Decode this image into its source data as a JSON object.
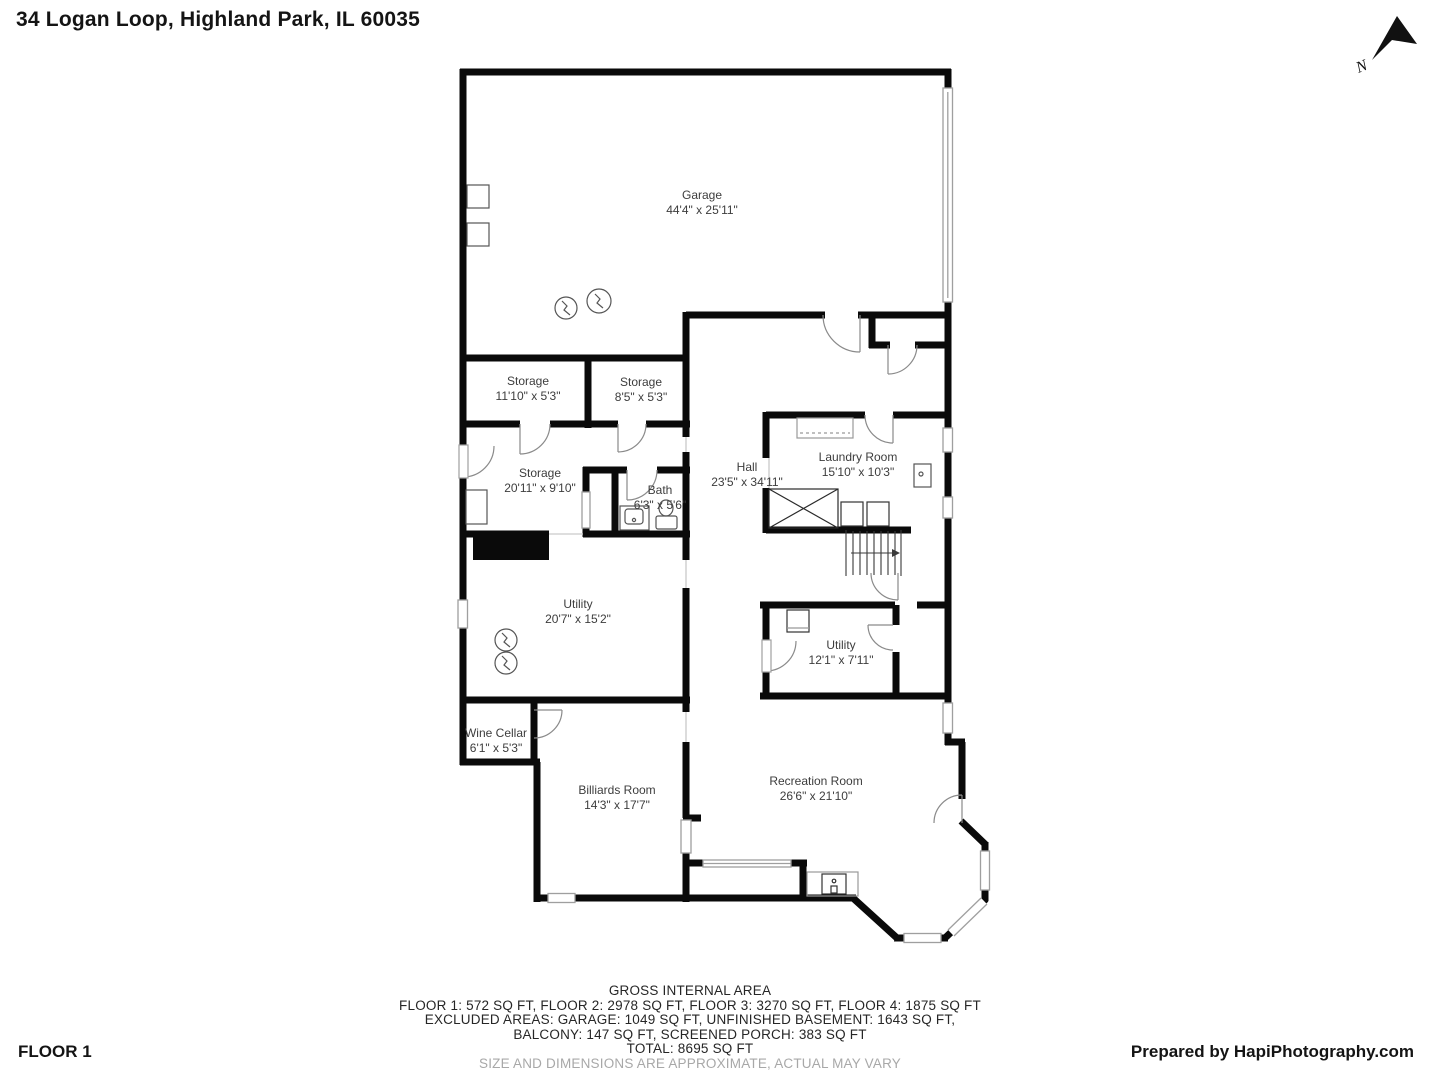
{
  "header": {
    "title": "34 Logan Loop, Highland Park, IL 60035"
  },
  "compass": {
    "north_label": "N"
  },
  "rooms": [
    {
      "id": "garage",
      "name": "Garage",
      "dims": "44'4\" x 25'11\""
    },
    {
      "id": "storage-1",
      "name": "Storage",
      "dims": "11'10\" x 5'3\""
    },
    {
      "id": "storage-2",
      "name": "Storage",
      "dims": "8'5\" x 5'3\""
    },
    {
      "id": "storage-3",
      "name": "Storage",
      "dims": "20'11\" x 9'10\""
    },
    {
      "id": "bath",
      "name": "Bath",
      "dims": "6'3\" x 5'6\""
    },
    {
      "id": "hall",
      "name": "Hall",
      "dims": "23'5\" x 34'11\""
    },
    {
      "id": "laundry",
      "name": "Laundry Room",
      "dims": "15'10\" x 10'3\""
    },
    {
      "id": "utility-1",
      "name": "Utility",
      "dims": "20'7\" x 15'2\""
    },
    {
      "id": "utility-2",
      "name": "Utility",
      "dims": "12'1\" x 7'11\""
    },
    {
      "id": "wine-cellar",
      "name": "Wine Cellar",
      "dims": "6'1\" x 5'3\""
    },
    {
      "id": "billiards",
      "name": "Billiards Room",
      "dims": "14'3\" x 17'7\""
    },
    {
      "id": "recreation",
      "name": "Recreation Room",
      "dims": "26'6\" x 21'10\""
    }
  ],
  "area_summary": {
    "title": "GROSS INTERNAL AREA",
    "floors": "FLOOR 1: 572 SQ FT, FLOOR 2: 2978 SQ FT, FLOOR 3: 3270 SQ FT, FLOOR 4: 1875 SQ FT",
    "excluded1": "EXCLUDED AREAS: GARAGE: 1049 SQ FT, UNFINISHED BASEMENT: 1643 SQ FT,",
    "excluded2": "BALCONY: 147 SQ FT, SCREENED PORCH: 383 SQ FT",
    "total": "TOTAL: 8695 SQ FT",
    "disclaimer": "SIZE AND DIMENSIONS ARE APPROXIMATE, ACTUAL MAY VARY"
  },
  "footer": {
    "floor_label": "FLOOR 1",
    "credit": "Prepared by HapiPhotography.com"
  },
  "colors": {
    "wall": "#0a0a0a",
    "window": "#9f9f9f",
    "door_arc": "#8a8a8a",
    "label": "#3d3d3d"
  }
}
